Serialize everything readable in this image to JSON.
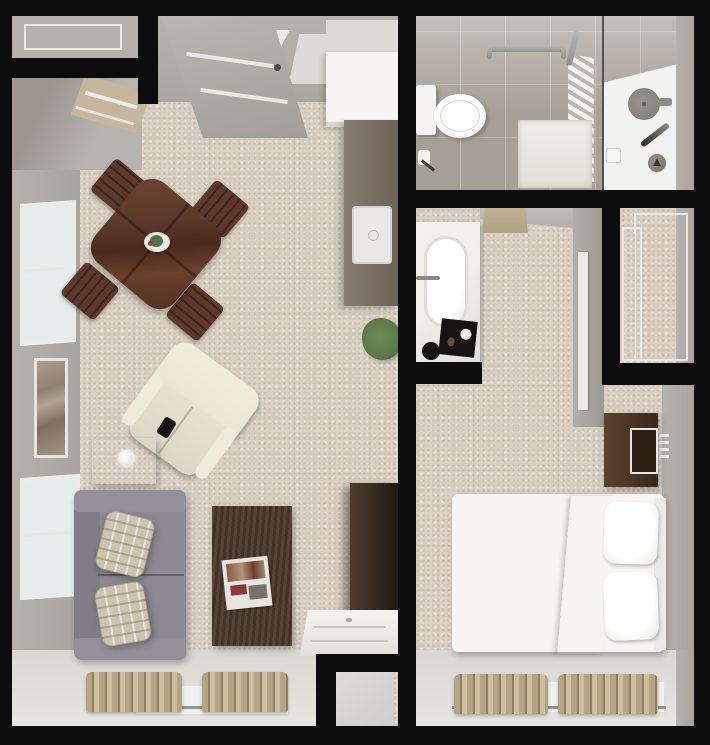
{
  "image_type": "3d-rendered floor plan, top-down view, one-bedroom apartment, no visible text",
  "colors": {
    "wall": "#0d0d0d",
    "carpet": "#d8cec2",
    "wall_gray": "#a8a49e",
    "wall_gray_light": "#c4c1bb",
    "floor_light": "#e7e5e0",
    "bath_tile": "#a6a196",
    "shower_white": "#f2f2f0",
    "counter_taupe": "#7d7267",
    "wood_red": "#5c392a",
    "wood_dark": "#43332a",
    "wood_darker": "#352a20",
    "nightstand": "#4a3423",
    "sofa": "#8c8992",
    "sofa_dark": "#807d87",
    "plaid": "#ccc3b1",
    "cream": "#eae6d7",
    "duvet": "#8e8b83",
    "white": "#f6f5f3",
    "curtain": "#b4a485",
    "curtain_dark": "#8e7f62",
    "plant": "#5d7a4a",
    "glass": "#e4edeb",
    "chrome": "#8f8f8c",
    "marble": "#efeeea",
    "black_item": "#161412"
  },
  "rooms": [
    {
      "name": "living-dining-room",
      "contents": [
        "dining-table-with-centerpiece",
        "four-dining-chairs",
        "cream-recliner",
        "side-table-with-lamp",
        "gray-loveseat",
        "two-plaid-throw-pillows",
        "coffee-table-with-magazines",
        "media-cabinet",
        "white-desk",
        "wall-art",
        "left-wall-windows",
        "bottom-window-with-curtains"
      ]
    },
    {
      "name": "entry",
      "contents": [
        "door-alcove",
        "entry-door",
        "hall-runner"
      ]
    },
    {
      "name": "kitchen",
      "contents": [
        "refrigerator",
        "counter-with-sink",
        "potted-plant"
      ]
    },
    {
      "name": "bathroom",
      "contents": [
        "toilet",
        "toilet-paper-holder",
        "grab-bars",
        "bath-mat",
        "towel-shelf",
        "glass-partition",
        "shower-head",
        "shower-valve",
        "soap-dish"
      ]
    },
    {
      "name": "bedroom-suite",
      "contents": [
        "vanity-counter-with-oval-sink",
        "faucet",
        "black-tray-and-bowl",
        "door-mat",
        "sliding-door-closet",
        "nightstand",
        "bed-gray-duvet-white-sheets-two-pillows",
        "headboard",
        "bottom-window-with-curtains"
      ]
    },
    {
      "name": "storage-nook",
      "contents": []
    }
  ]
}
